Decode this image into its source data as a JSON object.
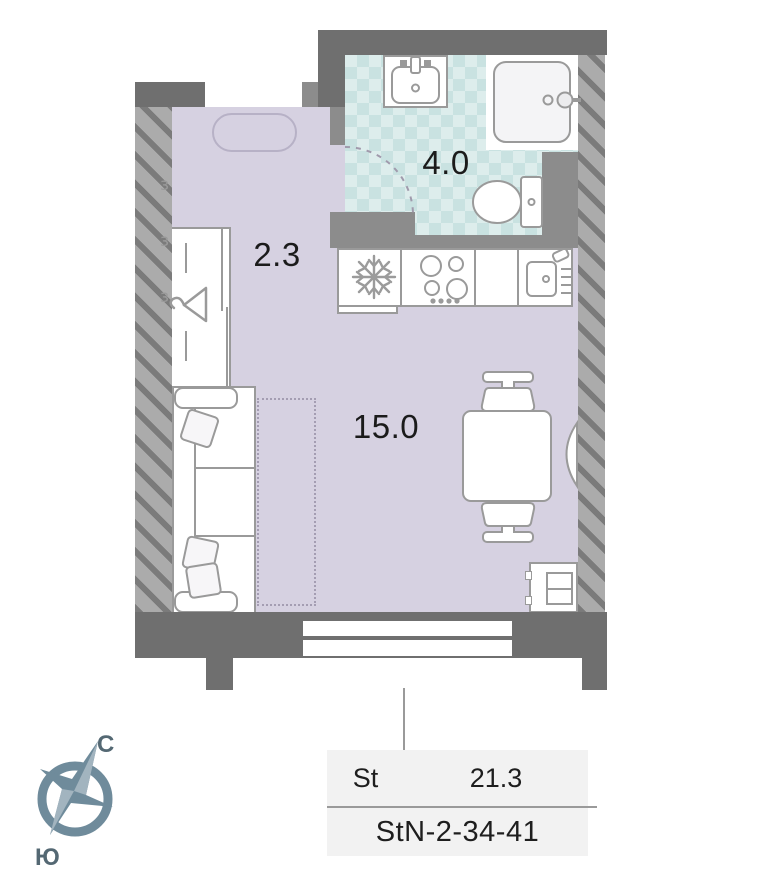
{
  "plan": {
    "title": "studio-floor-plan",
    "rooms": [
      {
        "name": "hallway",
        "area": "2.3"
      },
      {
        "name": "bathroom",
        "area": "4.0"
      },
      {
        "name": "living-room",
        "area": "15.0"
      }
    ],
    "fixtures": [
      "wardrobe",
      "sofa",
      "sofa-bed-outline",
      "dining-table",
      "chairs",
      "cabinet",
      "fridge",
      "stove",
      "kitchen-sink",
      "bath-sink",
      "shower",
      "toilet",
      "radiator",
      "window",
      "rug-oval"
    ],
    "icons": [
      "snowflake-icon",
      "hanger-icon",
      "burners-icon",
      "faucet-icon",
      "door-arc-icon",
      "compass-rose-icon"
    ]
  },
  "compass": {
    "north": "С",
    "south": "Ю"
  },
  "legend": {
    "type": "St",
    "area": "21.3",
    "unit": "StN-2-34-41"
  },
  "colors": {
    "floor": "#d6d1e1",
    "tile_light": "#ddedec",
    "tile_dark": "#c9e2e1",
    "wall_dark": "#6f6f6f",
    "wall_interior": "#8c8c8c",
    "hatch_stripe": "#7b7b7b",
    "hatch_bg": "#ababab",
    "furniture_outline": "#9a9a9a",
    "compass": "#6f8b9b",
    "legend_bg": "#f2f2f2",
    "text": "#1b1b1b"
  }
}
